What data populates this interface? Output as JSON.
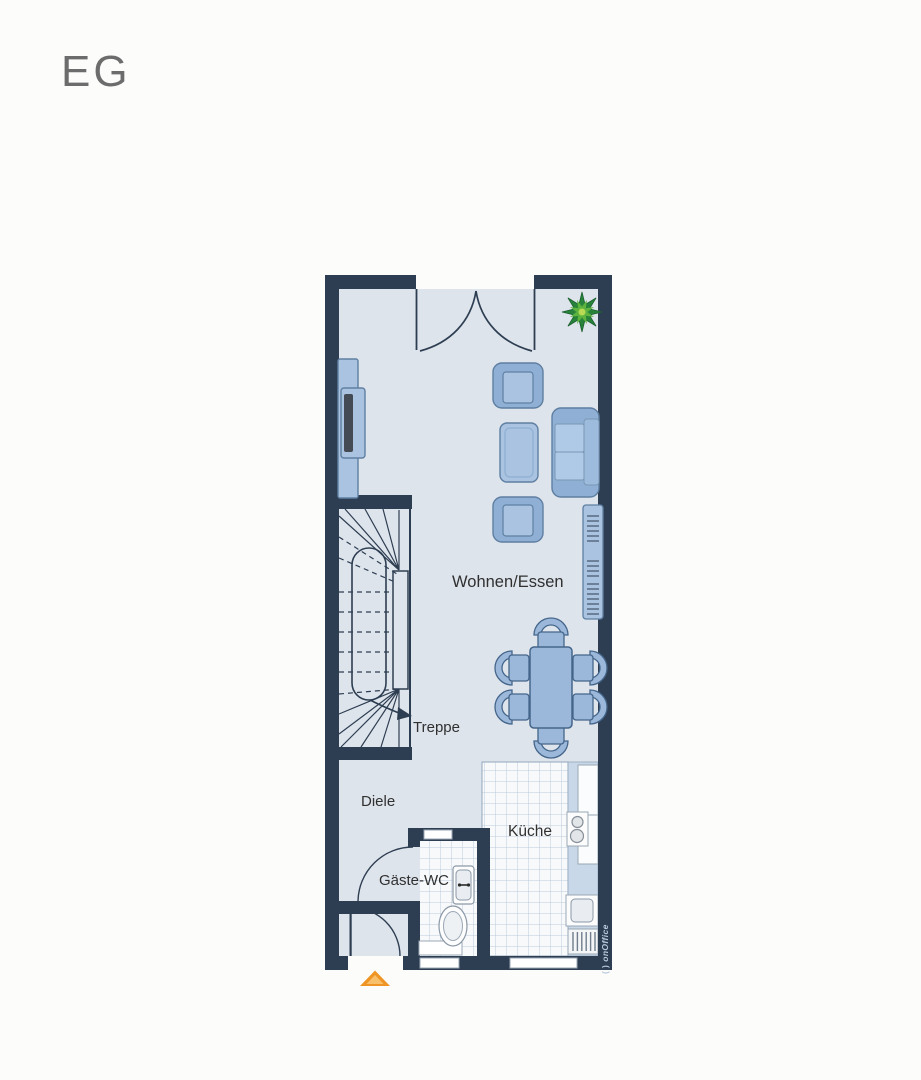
{
  "page": {
    "floor_label": "EG"
  },
  "floorplan": {
    "rooms": [
      {
        "id": "wohnen-essen",
        "label": "Wohnen/Essen"
      },
      {
        "id": "treppe",
        "label": "Treppe"
      },
      {
        "id": "diele",
        "label": "Diele"
      },
      {
        "id": "gaeste-wc",
        "label": "Gäste-WC"
      },
      {
        "id": "kueche",
        "label": "Küche"
      }
    ],
    "furniture": [
      "tv-sideboard",
      "tv",
      "armchair",
      "ottoman",
      "armchair",
      "sofa",
      "wall-shelf",
      "dining-table",
      "dining-chair x6",
      "potted-plant",
      "kitchen-counter",
      "tall-cabinets",
      "cooktop-2-burners",
      "kitchen-sink",
      "dishwasher",
      "washbasin",
      "toilet",
      "radiator",
      "winder-staircase"
    ],
    "doors": [
      "double-french-door-top",
      "entrance-door-bottom-left",
      "wc-door"
    ],
    "windows_count": 3,
    "entrance_marker": "orange-triangle",
    "watermark": {
      "logo": "( )",
      "name": "onOffice"
    },
    "colors": {
      "wall": "#2e3e52",
      "floor": "#dee4ec",
      "furniture_light": "#a9c3e0",
      "furniture_medium": "#8fb0d4",
      "dining_fill": "#9bb8da",
      "counter": "#c9d8e8",
      "tile_line": "#bccadb",
      "accent_orange": "#ef9526",
      "plant_green": "#27823a",
      "label_text": "#303030",
      "title_text": "#6c6c6c"
    }
  }
}
